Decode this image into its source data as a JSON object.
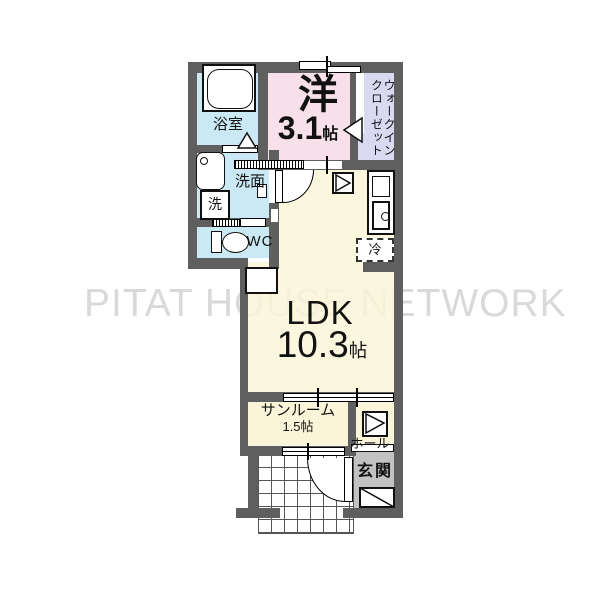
{
  "watermark_text": "PITAT HOUSE NETWORK",
  "rooms": {
    "bedroom": {
      "label": "洋",
      "area": "3.1",
      "area_unit": "帖"
    },
    "walk_in_closet": {
      "label_line1": "ウォークイン",
      "label_line2": "クローゼット"
    },
    "bathroom": {
      "label": "浴室"
    },
    "washroom": {
      "label": "洗面"
    },
    "washing_machine": {
      "label": "洗"
    },
    "wc": {
      "label": "WC"
    },
    "ldk": {
      "label": "LDK",
      "area": "10.3",
      "area_unit": "帖"
    },
    "refrigerator": {
      "label": "冷"
    },
    "sunroom": {
      "label": "サンルーム",
      "area": "1.5帖"
    },
    "hall": {
      "label": "ホール"
    },
    "entrance": {
      "label": "玄関"
    }
  },
  "colors": {
    "wall": "#5f5f5f",
    "bedroom_fill": "#f8e0ea",
    "closet_fill": "#d9d9f2",
    "wet_area_fill": "#cbe9f5",
    "ldk_fill": "#faf5d8",
    "entrance_fill": "#c2c2c2",
    "watermark": "#d9d9d9"
  }
}
